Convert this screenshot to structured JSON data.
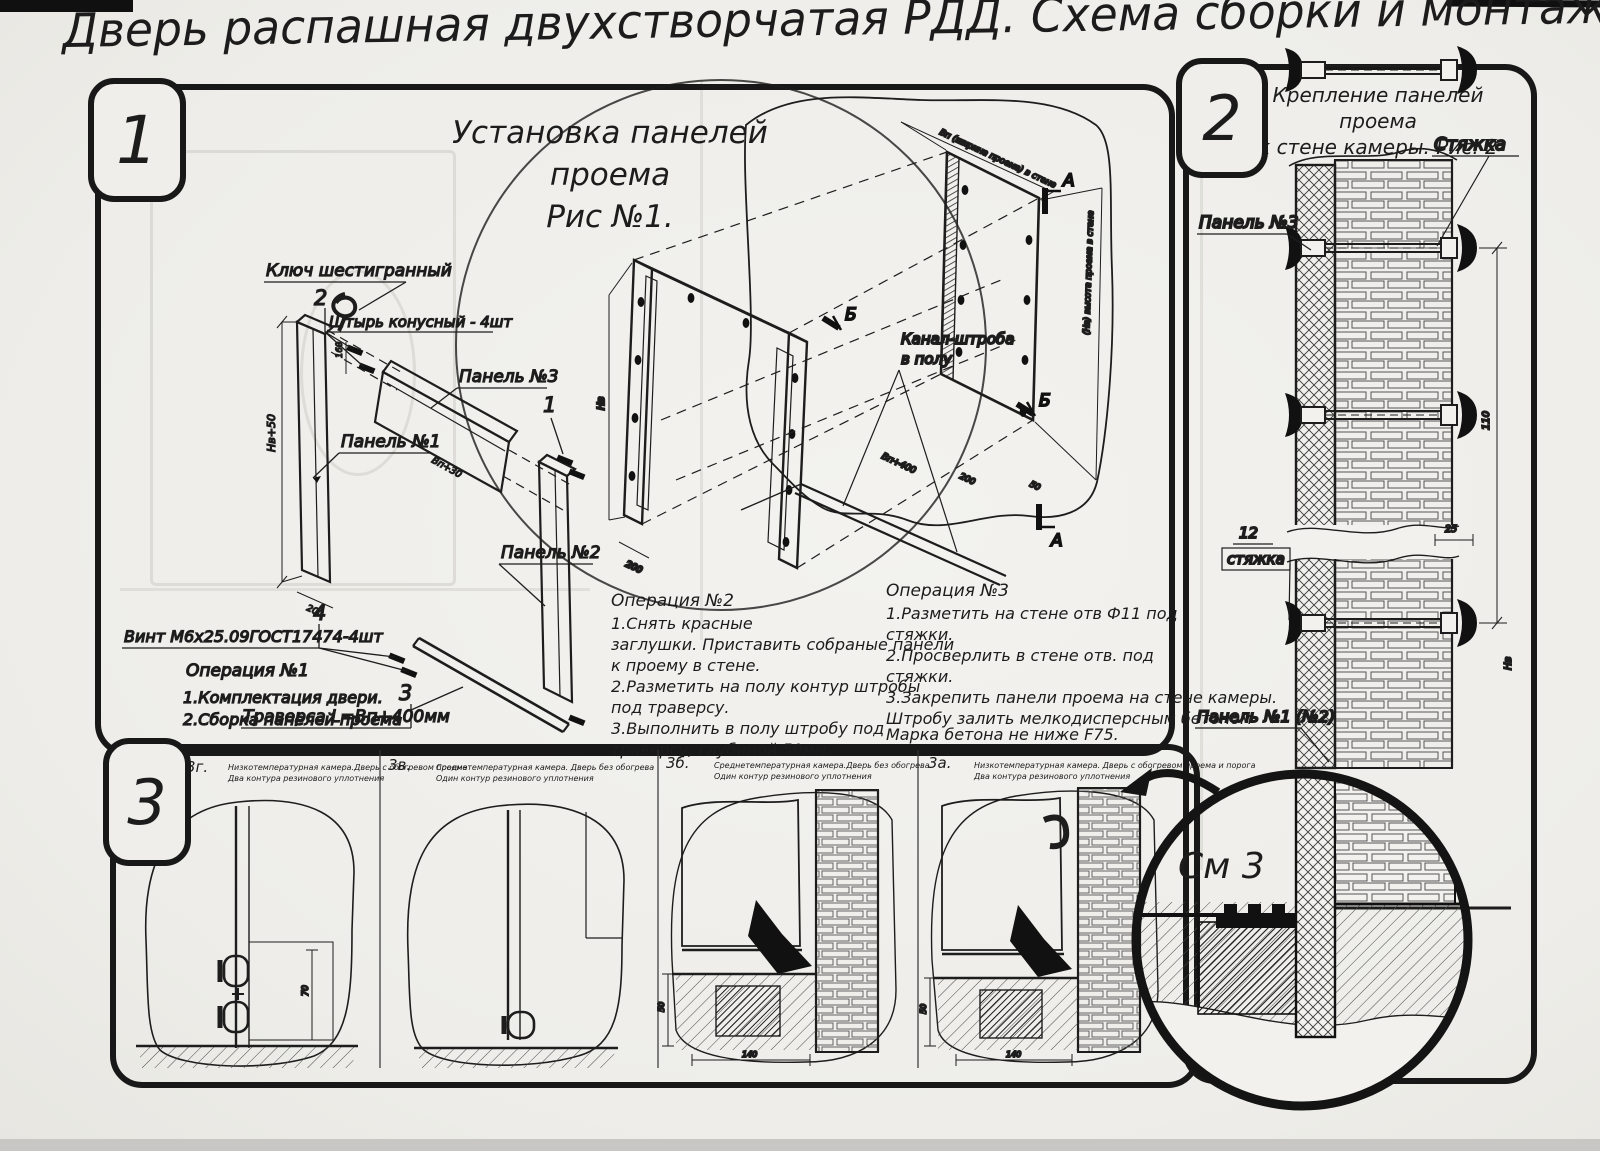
{
  "page": {
    "title": "Дверь распашная двухстворчатая РДД.  Схема сборки и монтажа №2"
  },
  "fig1": {
    "badge": "1",
    "heading1": "Установка панелей проема",
    "heading2": "Рис №1.",
    "labels": {
      "hex_key": "Ключ шестигранный",
      "pin_item": "2",
      "pin": "Штырь конусный - 4шт",
      "panel3": "Панель №3",
      "panel1": "Панель №1",
      "panel2": "Панель №2",
      "item1": "1",
      "screw_item": "4",
      "screw": "Винт М6х25.09ГОСТ17474-4шт",
      "trav_item": "3",
      "traverse": "Траверса  L=Bп+400мм",
      "channel1": "Канал-штроба",
      "channel2": "в полу",
      "marker_a": "А",
      "marker_b": "Б"
    },
    "dims": {
      "h_panel1": "Нв+50",
      "w160": "160",
      "w_panel3": "Вп+30",
      "w200a": "200",
      "h_frame": "Нв",
      "w200b": "200",
      "w200c": "200",
      "w50": "50",
      "trav_len": "Вп+400",
      "open_w": "Вп (ширина проема) в стене",
      "open_h": "(Нв) высота проема в стене"
    },
    "op1": [
      "Операция №1",
      "1.Комплектация двери.",
      "2.Сборка панелей проема"
    ],
    "op2": [
      "Операция №2",
      "1.Снять красные",
      "заглушки. Приставить собраные панели",
      "к проему в стене.",
      "2.Разметить на полу контур штробы",
      "под траверсу.",
      "3.Выполнить в полу штробу под",
      "траверсу, глубиной 50мм."
    ],
    "op3": [
      "Операция №3",
      "1.Разметить на стене отв Ф11 под",
      "стяжки.",
      "2.Просверлить в стене отв.  под",
      "стяжки.",
      "3.Закрепить панели проема на стене камеры.",
      "Штробу залить мелкодисперсным бетоном",
      "Марка бетона не ниже  F75."
    ]
  },
  "fig2": {
    "badge": "2",
    "heading1": "Крепление панелей проема",
    "heading2": "к стене камеры. Рис. 2",
    "labels": {
      "styazhka": "Стяжка",
      "panel3": "Панель №3",
      "item12": "12",
      "styazhka2": "стяжка",
      "panel12": "Панель №1 (№2)",
      "see3": "См 3"
    },
    "dims": {
      "d110": "110",
      "d25": "25",
      "dnv": "Нв"
    }
  },
  "fig3": {
    "badge": "3",
    "cells": [
      {
        "id": "3г.",
        "line1": "Низкотемпературная камера.Дверь с обогревом проема",
        "line2": "Два контура резинового уплотнения",
        "dim1": "70"
      },
      {
        "id": "3в.",
        "line1": "Среднетемпературная камера. Дверь без обогрева",
        "line2": "Один контур резинового уплотнения"
      },
      {
        "id": "3б.",
        "line1": "Среднетемпературная камера.Дверь без обогрева",
        "line2": "Один контур резинового уплотнения",
        "dim1": "50",
        "dim2": "140"
      },
      {
        "id": "3а.",
        "line1": "Низкотемпературная камера. Дверь с обогревом проема и порога",
        "line2": "Два контура резинового уплотнения",
        "dim1": "50",
        "dim2": "140"
      }
    ]
  }
}
